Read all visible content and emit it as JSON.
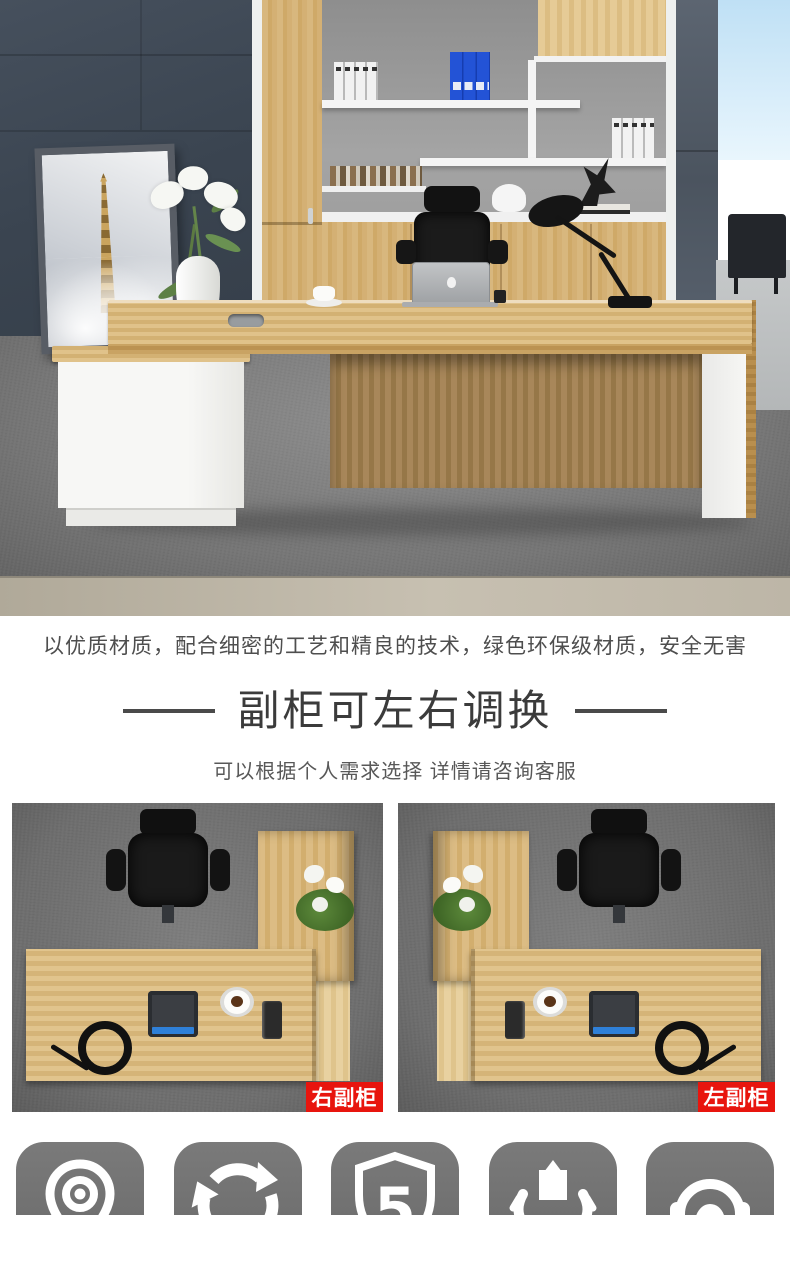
{
  "intro": {
    "text": "以优质材质，配合细密的工艺和精良的技术，绿色环保级材质，安全无害"
  },
  "section": {
    "title": "副柜可左右调换",
    "subtitle": "可以根据个人需求选择 详情请咨询客服"
  },
  "variants": [
    {
      "label": "右副柜"
    },
    {
      "label": "左副柜"
    }
  ],
  "feature_icons": [
    {
      "name": "location-pin-icon"
    },
    {
      "name": "recycle-icon"
    },
    {
      "name": "shield-5-icon",
      "number": "5"
    },
    {
      "name": "hands-holding-bag-icon"
    },
    {
      "name": "headset-service-icon"
    }
  ],
  "colors": {
    "label_red": "#e8150e",
    "icon_gray": "#707070",
    "wall_dark": "#3d4754",
    "wood": "#d2ab72",
    "binder_blue": "#2353d6"
  }
}
